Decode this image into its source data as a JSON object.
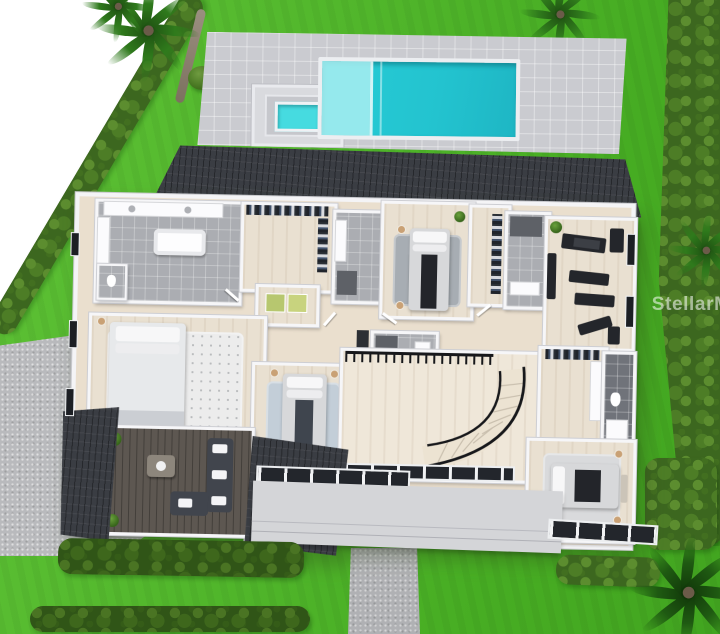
{
  "title": "3D aerial dollhouse floor plan rendering of a single-family home with pool",
  "watermark": {
    "text": "StellarMLS"
  },
  "colors": {
    "lawn": "#52b72c",
    "hedge": "#3c671f",
    "pool_water": "#27ccd6",
    "pool_ledge": "#a9eef1",
    "spa_water": "#46dbe0",
    "deck": "#cacbd0",
    "roof": "#3a3d43",
    "wall": "#f6f6f8",
    "wood": "#e9e0d1",
    "tile": "#abadb2",
    "tile_dark": "#70737a",
    "deckwood": "#5d5751",
    "paver": "#b9babd",
    "porch": "#d4d5d8",
    "furn_dark": "#24262b",
    "appliance_green": "#b7c76f"
  },
  "scene": {
    "objects": [
      "lawn",
      "boxwood-hedges",
      "palm-trees",
      "pool-deck",
      "swimming-pool",
      "tanning-ledge",
      "spa",
      "driveway",
      "front-walkway",
      "shingle-roof",
      "primary-bathroom",
      "walk-in-closets",
      "laundry-closet",
      "bedroom-2",
      "bathroom-2",
      "bathroom-3",
      "home-gym",
      "primary-bedroom",
      "primary-bathroom-2",
      "bedroom-3",
      "grand-hall",
      "curved-staircase",
      "loft-railing",
      "bathroom-4",
      "bedroom-4",
      "covered-balcony-lounge",
      "window-walls",
      "porch-slab"
    ]
  }
}
